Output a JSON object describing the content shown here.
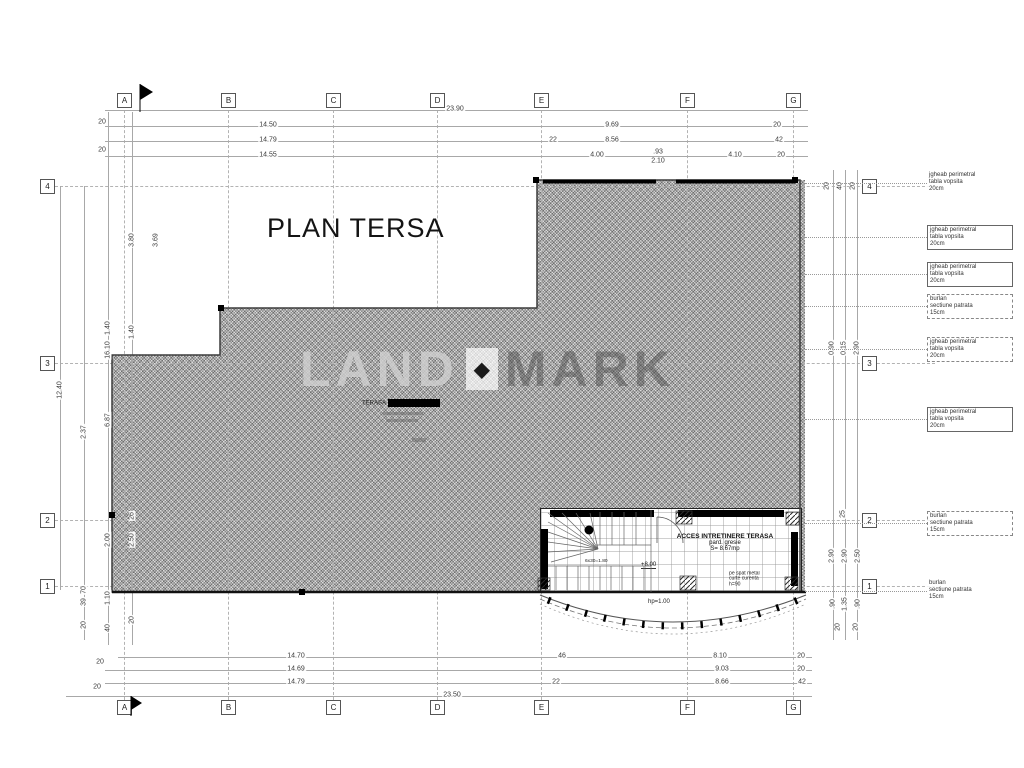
{
  "title": "PLAN TERSA",
  "watermark": {
    "left": "LAND",
    "diamond": "◆",
    "right": "MARK"
  },
  "terasa_label": {
    "text": "TERASA"
  },
  "room": {
    "title": "ACCES INTRETINERE TERASA",
    "finish": "pard. gresie",
    "area": "S= 8.67mp",
    "level": "+8.00",
    "stair_note": "6x30=1.80",
    "note1": "pe spat metal",
    "note2": "curte curenta",
    "note3": "h=90",
    "parapet": "hp=1.00"
  },
  "grid": {
    "cols": [
      {
        "label": "A",
        "x": 124
      },
      {
        "label": "B",
        "x": 228
      },
      {
        "label": "C",
        "x": 333
      },
      {
        "label": "D",
        "x": 437
      },
      {
        "label": "E",
        "x": 541
      },
      {
        "label": "F",
        "x": 687
      },
      {
        "label": "G",
        "x": 793
      }
    ],
    "rows": [
      {
        "label": "4",
        "y": 186
      },
      {
        "label": "3",
        "y": 363
      },
      {
        "label": "2",
        "y": 520
      },
      {
        "label": "1",
        "y": 586
      }
    ]
  },
  "dims": {
    "top": [
      {
        "v": "23.90",
        "x": 455,
        "y": 109
      },
      {
        "v": "14.50",
        "x": 268,
        "y": 125
      },
      {
        "v": "9.69",
        "x": 612,
        "y": 125
      },
      {
        "v": "20",
        "x": 777,
        "y": 125
      },
      {
        "v": "14.79",
        "x": 268,
        "y": 140
      },
      {
        "v": "22",
        "x": 553,
        "y": 140
      },
      {
        "v": "8.56",
        "x": 612,
        "y": 140
      },
      {
        "v": "42",
        "x": 779,
        "y": 140
      },
      {
        "v": "14.55",
        "x": 268,
        "y": 155
      },
      {
        "v": "4.00",
        "x": 597,
        "y": 155
      },
      {
        "v": ".93",
        "x": 658,
        "y": 152
      },
      {
        "v": "2.10",
        "x": 658,
        "y": 161
      },
      {
        "v": "4.10",
        "x": 735,
        "y": 155
      },
      {
        "v": "20",
        "x": 781,
        "y": 155
      },
      {
        "v": "20",
        "x": 102,
        "y": 122
      },
      {
        "v": "20",
        "x": 102,
        "y": 150
      }
    ],
    "bottom": [
      {
        "v": "14.70",
        "x": 296,
        "y": 656
      },
      {
        "v": "46",
        "x": 562,
        "y": 656
      },
      {
        "v": "8.10",
        "x": 720,
        "y": 656
      },
      {
        "v": "20",
        "x": 801,
        "y": 656
      },
      {
        "v": "14.69",
        "x": 296,
        "y": 669
      },
      {
        "v": "9.03",
        "x": 722,
        "y": 669
      },
      {
        "v": "20",
        "x": 801,
        "y": 669
      },
      {
        "v": "14.79",
        "x": 296,
        "y": 682
      },
      {
        "v": "22",
        "x": 556,
        "y": 682
      },
      {
        "v": "8.66",
        "x": 722,
        "y": 682
      },
      {
        "v": "42",
        "x": 802,
        "y": 682
      },
      {
        "v": "23.50",
        "x": 452,
        "y": 695
      },
      {
        "v": "20",
        "x": 100,
        "y": 662
      },
      {
        "v": "20",
        "x": 97,
        "y": 687
      }
    ],
    "left": [
      {
        "v": "12.40",
        "x": 60,
        "y": 390
      },
      {
        "v": "2.37",
        "x": 84,
        "y": 432
      },
      {
        "v": "70",
        "x": 84,
        "y": 590
      },
      {
        "v": "39",
        "x": 84,
        "y": 602
      },
      {
        "v": "20",
        "x": 84,
        "y": 625
      },
      {
        "v": "1.40",
        "x": 108,
        "y": 328
      },
      {
        "v": "16.10",
        "x": 108,
        "y": 350
      },
      {
        "v": "6.87",
        "x": 108,
        "y": 420
      },
      {
        "v": "2.00",
        "x": 108,
        "y": 540
      },
      {
        "v": "1.10",
        "x": 108,
        "y": 598
      },
      {
        "v": "40",
        "x": 108,
        "y": 628
      },
      {
        "v": "3.80",
        "x": 132,
        "y": 240
      },
      {
        "v": "1.40",
        "x": 132,
        "y": 332
      },
      {
        "v": "26",
        "x": 132,
        "y": 516
      },
      {
        "v": "2.50",
        "x": 132,
        "y": 540
      },
      {
        "v": "20",
        "x": 132,
        "y": 620
      },
      {
        "v": "3.69",
        "x": 156,
        "y": 240
      }
    ],
    "right": [
      {
        "v": "20",
        "x": 827,
        "y": 186
      },
      {
        "v": "40",
        "x": 840,
        "y": 186
      },
      {
        "v": "20",
        "x": 853,
        "y": 186
      },
      {
        "v": "0.90",
        "x": 832,
        "y": 348
      },
      {
        "v": "0.15",
        "x": 844,
        "y": 348
      },
      {
        "v": "2.90",
        "x": 857,
        "y": 348
      },
      {
        "v": "25",
        "x": 843,
        "y": 514
      },
      {
        "v": "2.90",
        "x": 832,
        "y": 556
      },
      {
        "v": "2.90",
        "x": 845,
        "y": 556
      },
      {
        "v": "2.50",
        "x": 858,
        "y": 556
      },
      {
        "v": ".90",
        "x": 833,
        "y": 604
      },
      {
        "v": "1.35",
        "x": 845,
        "y": 604
      },
      {
        "v": ".90",
        "x": 858,
        "y": 604
      },
      {
        "v": "20",
        "x": 838,
        "y": 627
      },
      {
        "v": "20",
        "x": 856,
        "y": 627
      }
    ]
  },
  "annotations": [
    {
      "y": 183,
      "cls": "none",
      "l1": "jgheab perimetral",
      "l2": "tabla vopsita",
      "l3": "20cm"
    },
    {
      "y": 237,
      "cls": "solid",
      "l1": "jgheab perimetral",
      "l2": "tabla vopsita",
      "l3": "20cm"
    },
    {
      "y": 274,
      "cls": "solid",
      "l1": "jgheab perimetral",
      "l2": "tabla vopsita",
      "l3": "20cm"
    },
    {
      "y": 306,
      "cls": "dashed",
      "l1": "burlan",
      "l2": "sectiune patrata",
      "l3": "15cm"
    },
    {
      "y": 349,
      "cls": "dashed",
      "l1": "jgheab perimetral",
      "l2": "tabla vopsita",
      "l3": "20cm"
    },
    {
      "y": 419,
      "cls": "solid",
      "l1": "jgheab perimetral",
      "l2": "tabla vopsita",
      "l3": "20cm"
    },
    {
      "y": 523,
      "cls": "dashed",
      "l1": "burlan",
      "l2": "sectiune patrata",
      "l3": "15cm"
    },
    {
      "y": 591,
      "cls": "none",
      "l1": "burlan",
      "l2": "sectiune patrata",
      "l3": "15cm"
    }
  ],
  "markers": [
    {
      "x": 533,
      "y": 177
    },
    {
      "x": 792,
      "y": 177
    },
    {
      "x": 109,
      "y": 512
    },
    {
      "x": 299,
      "y": 589
    },
    {
      "x": 218,
      "y": 305
    }
  ]
}
